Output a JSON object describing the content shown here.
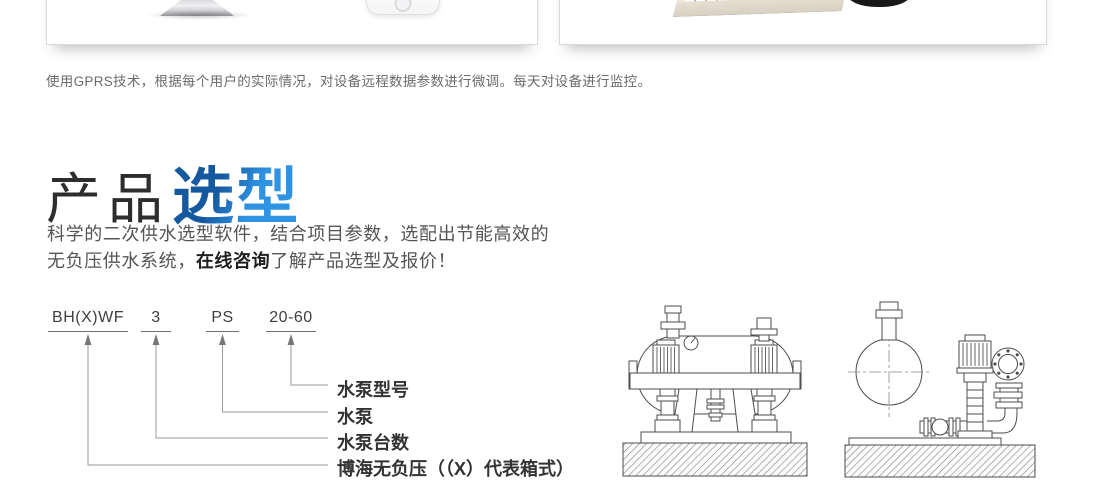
{
  "colors": {
    "accent_blue": "#1e7ad0",
    "title_gradient_from": "#14589f",
    "title_gradient_to": "#2f93e4",
    "text_gray": "#666666",
    "text_dark": "#333333"
  },
  "hero": {
    "caption": "使用GPRS技术，根据每个用户的实际情况，对设备远程数据参数进行微调。每天对设备进行监控。"
  },
  "section": {
    "title_black": "产品",
    "title_blue": "选型",
    "desc_part1": "科学的二次供水选型软件，结合项目参数，选配出节能高效的无负压供水系统，",
    "desc_link": "在线咨询",
    "desc_part2": "了解产品选型及报价！"
  },
  "model_diagram": {
    "codes": [
      "BH(X)WF",
      "3",
      "PS",
      "20-60"
    ],
    "labels": [
      "水泵型号",
      "水泵",
      "水泵台数",
      "博海无负压（（X）代表箱式）"
    ]
  },
  "figures": {
    "left_figure": "horizontal-tank-pump-unit-line-drawing",
    "right_figure": "tank-and-vertical-pump-line-drawing"
  }
}
